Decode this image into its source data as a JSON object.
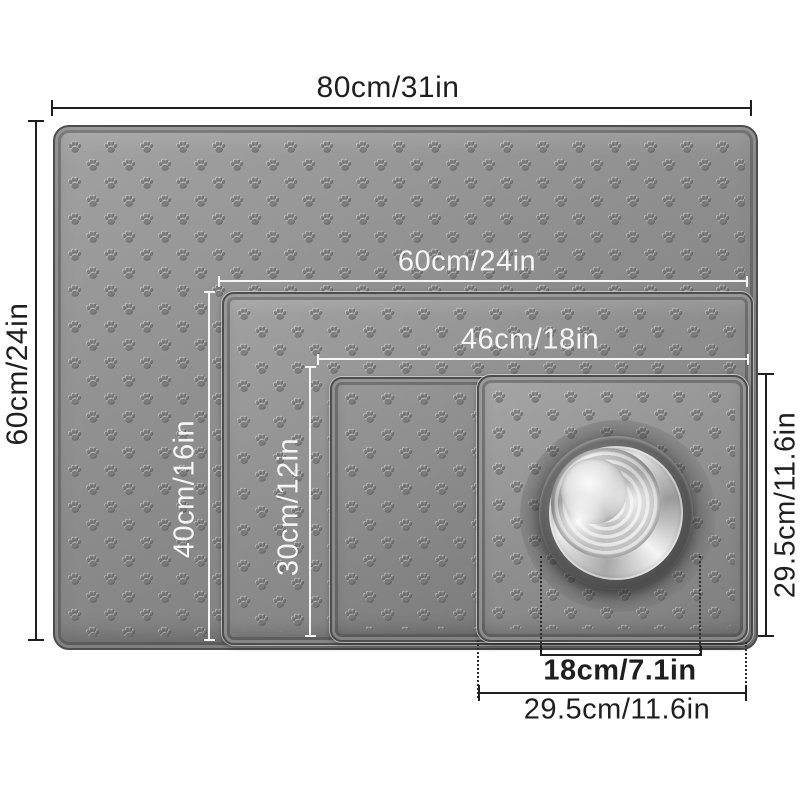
{
  "product_diagram": {
    "description_labels": {
      "overall_width": "80cm/31in",
      "overall_height": "60cm/24in",
      "mat2_width": "60cm/24in",
      "mat2_height": "40cm/16in",
      "mat3_width": "46cm/18in",
      "mat3_height": "30cm/12in",
      "mat4_width": "29.5cm/11.6in",
      "mat4_height": "29.5cm/11.6in",
      "bowl_diameter": "18cm/7.1in"
    },
    "mats": [
      {
        "id": "mat-xl",
        "width_label": "80cm/31in",
        "height_label": "60cm/24in",
        "label_style": "dark-outside"
      },
      {
        "id": "mat-l",
        "width_label": "60cm/24in",
        "height_label": "40cm/16in",
        "label_style": "light-on-mat"
      },
      {
        "id": "mat-m",
        "width_label": "46cm/18in",
        "height_label": "30cm/12in",
        "label_style": "light-on-mat"
      },
      {
        "id": "mat-s",
        "width_label": "29.5cm/11.6in",
        "height_label": "29.5cm/11.6in",
        "label_style": "dark-outside"
      }
    ],
    "bowl": {
      "diameter_label": "18cm/7.1in"
    },
    "colors": {
      "background": "#ffffff",
      "mat_surface": "#8d8d8d",
      "mat_edge": "#4d4d4d",
      "dim_dark": "#1f1f1f",
      "dim_light": "#f5f5f5",
      "bowl_steel": "#d9d9d9"
    }
  }
}
